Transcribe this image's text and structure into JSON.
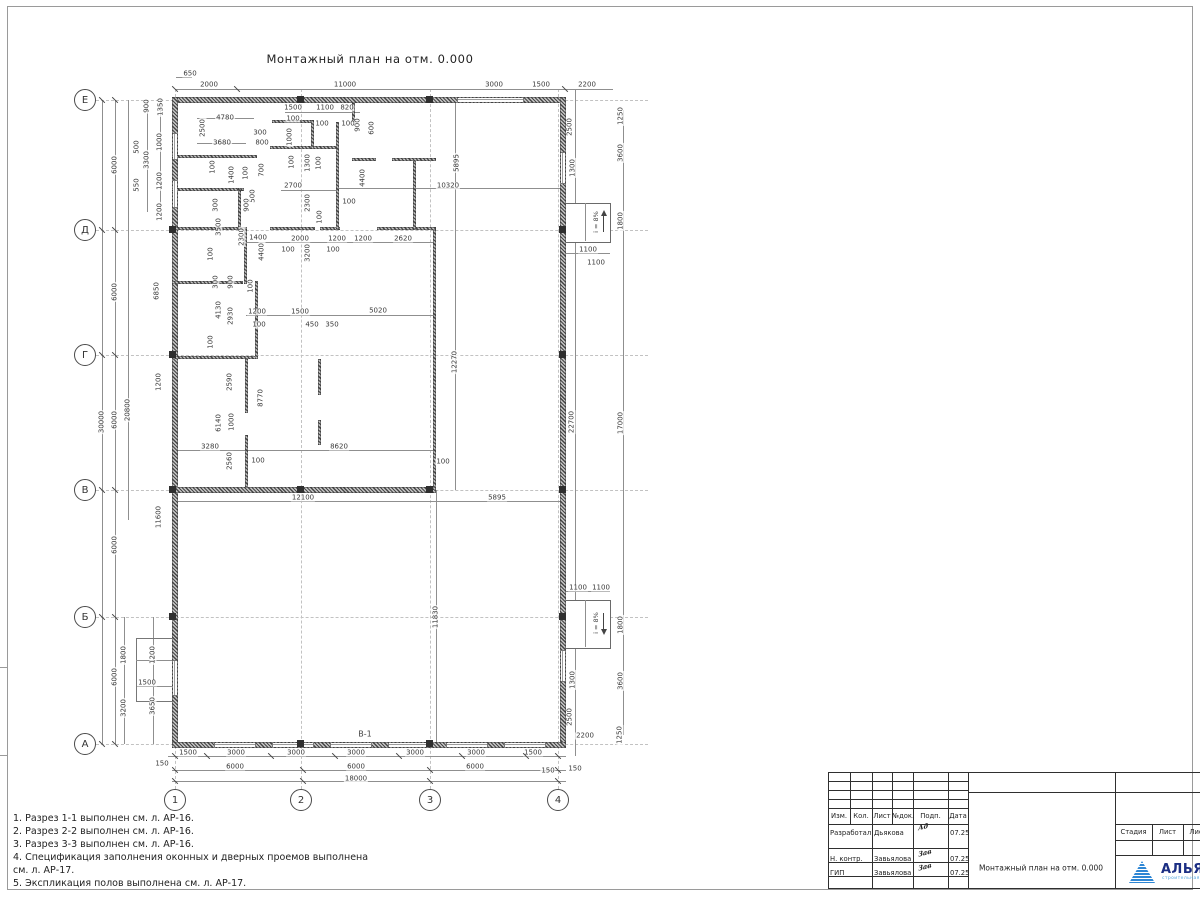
{
  "sheet": {
    "title": "Монтажный план на отм. 0.000",
    "plan_label": "В-1",
    "ramp_label": "i = 8%"
  },
  "colors": {
    "logo_blue": "#2e86d4",
    "logo_navy": "#1b2e83",
    "logo_sub": "#53a6e0"
  },
  "axes": {
    "rows": [
      {
        "label": "Е",
        "y": 100
      },
      {
        "label": "Д",
        "y": 230
      },
      {
        "label": "Г",
        "y": 355
      },
      {
        "label": "В",
        "y": 490
      },
      {
        "label": "Б",
        "y": 617
      },
      {
        "label": "А",
        "y": 744
      }
    ],
    "cols": [
      {
        "label": "1",
        "x": 175
      },
      {
        "label": "2",
        "x": 301
      },
      {
        "label": "3",
        "x": 430
      },
      {
        "label": "4",
        "x": 558
      }
    ]
  },
  "notes": [
    "1. Разрез 1-1 выполнен см. л. АР-16.",
    "2. Разрез 2-2 выполнен см. л. АР-16.",
    "3. Разрез 3-3 выполнен см. л. АР-16.",
    "4. Спецификация заполнения оконных и дверных проемов выполнена",
    "см. л. АР-17.",
    "5. Экспликация полов выполнена см. л. АР-17."
  ],
  "dims": [
    {
      "t": "650",
      "x": 190,
      "y": 74
    },
    {
      "t": "2000",
      "x": 209,
      "y": 85
    },
    {
      "t": "11000",
      "x": 345,
      "y": 85
    },
    {
      "t": "3000",
      "x": 494,
      "y": 85
    },
    {
      "t": "1500",
      "x": 541,
      "y": 85
    },
    {
      "t": "2200",
      "x": 587,
      "y": 85
    },
    {
      "t": "1250",
      "x": 621,
      "y": 116,
      "v": 1
    },
    {
      "t": "2500",
      "x": 570,
      "y": 127,
      "v": 1
    },
    {
      "t": "3600",
      "x": 621,
      "y": 153,
      "v": 1
    },
    {
      "t": "1300",
      "x": 573,
      "y": 168,
      "v": 1
    },
    {
      "t": "1800",
      "x": 621,
      "y": 221,
      "v": 1
    },
    {
      "t": "1100",
      "x": 588,
      "y": 250
    },
    {
      "t": "1100",
      "x": 596,
      "y": 263
    },
    {
      "t": "5895",
      "x": 457,
      "y": 163,
      "v": 1
    },
    {
      "t": "10320",
      "x": 448,
      "y": 186
    },
    {
      "t": "4400",
      "x": 363,
      "y": 178,
      "v": 1
    },
    {
      "t": "12270",
      "x": 455,
      "y": 362,
      "v": 1
    },
    {
      "t": "22700",
      "x": 572,
      "y": 422,
      "v": 1
    },
    {
      "t": "17000",
      "x": 621,
      "y": 423,
      "v": 1
    },
    {
      "t": "5895",
      "x": 497,
      "y": 498
    },
    {
      "t": "11830",
      "x": 436,
      "y": 617,
      "v": 1
    },
    {
      "t": "1100",
      "x": 578,
      "y": 588
    },
    {
      "t": "1100",
      "x": 601,
      "y": 588
    },
    {
      "t": "1800",
      "x": 621,
      "y": 625,
      "v": 1
    },
    {
      "t": "3600",
      "x": 621,
      "y": 681,
      "v": 1
    },
    {
      "t": "1300",
      "x": 573,
      "y": 680,
      "v": 1
    },
    {
      "t": "2500",
      "x": 570,
      "y": 717,
      "v": 1
    },
    {
      "t": "2200",
      "x": 585,
      "y": 736
    },
    {
      "t": "1250",
      "x": 620,
      "y": 735,
      "v": 1
    },
    {
      "t": "150",
      "x": 575,
      "y": 769
    },
    {
      "t": "900",
      "x": 147,
      "y": 106,
      "v": 1
    },
    {
      "t": "1350",
      "x": 161,
      "y": 107,
      "v": 1
    },
    {
      "t": "500",
      "x": 137,
      "y": 147,
      "v": 1
    },
    {
      "t": "1000",
      "x": 160,
      "y": 142,
      "v": 1
    },
    {
      "t": "3300",
      "x": 147,
      "y": 160,
      "v": 1
    },
    {
      "t": "550",
      "x": 137,
      "y": 185,
      "v": 1
    },
    {
      "t": "1200",
      "x": 160,
      "y": 181,
      "v": 1
    },
    {
      "t": "1200",
      "x": 160,
      "y": 212,
      "v": 1
    },
    {
      "t": "6000",
      "x": 115,
      "y": 165,
      "v": 1
    },
    {
      "t": "6850",
      "x": 157,
      "y": 291,
      "v": 1
    },
    {
      "t": "6000",
      "x": 115,
      "y": 292,
      "v": 1
    },
    {
      "t": "1200",
      "x": 159,
      "y": 382,
      "v": 1
    },
    {
      "t": "30000",
      "x": 102,
      "y": 422,
      "v": 1
    },
    {
      "t": "6000",
      "x": 115,
      "y": 420,
      "v": 1
    },
    {
      "t": "20800",
      "x": 128,
      "y": 410,
      "v": 1
    },
    {
      "t": "11600",
      "x": 159,
      "y": 517,
      "v": 1
    },
    {
      "t": "6000",
      "x": 115,
      "y": 545,
      "v": 1
    },
    {
      "t": "1800",
      "x": 124,
      "y": 655,
      "v": 1
    },
    {
      "t": "1200",
      "x": 153,
      "y": 655,
      "v": 1
    },
    {
      "t": "6000",
      "x": 115,
      "y": 677,
      "v": 1
    },
    {
      "t": "1500",
      "x": 147,
      "y": 683
    },
    {
      "t": "3200",
      "x": 124,
      "y": 708,
      "v": 1
    },
    {
      "t": "3650",
      "x": 153,
      "y": 706,
      "v": 1
    },
    {
      "t": "1500",
      "x": 188,
      "y": 753
    },
    {
      "t": "3000",
      "x": 236,
      "y": 753
    },
    {
      "t": "3000",
      "x": 296,
      "y": 753
    },
    {
      "t": "3000",
      "x": 356,
      "y": 753
    },
    {
      "t": "3000",
      "x": 415,
      "y": 753
    },
    {
      "t": "3000",
      "x": 476,
      "y": 753
    },
    {
      "t": "1500",
      "x": 533,
      "y": 753
    },
    {
      "t": "150",
      "x": 162,
      "y": 764
    },
    {
      "t": "150",
      "x": 548,
      "y": 771
    },
    {
      "t": "6000",
      "x": 235,
      "y": 767
    },
    {
      "t": "6000",
      "x": 356,
      "y": 767
    },
    {
      "t": "6000",
      "x": 475,
      "y": 767
    },
    {
      "t": "18000",
      "x": 356,
      "y": 779
    },
    {
      "t": "4780",
      "x": 225,
      "y": 118
    },
    {
      "t": "2500",
      "x": 203,
      "y": 128,
      "v": 1
    },
    {
      "t": "3680",
      "x": 222,
      "y": 143
    },
    {
      "t": "300",
      "x": 260,
      "y": 133
    },
    {
      "t": "800",
      "x": 262,
      "y": 143
    },
    {
      "t": "100",
      "x": 213,
      "y": 167,
      "v": 1
    },
    {
      "t": "1400",
      "x": 232,
      "y": 175,
      "v": 1
    },
    {
      "t": "100",
      "x": 246,
      "y": 173,
      "v": 1
    },
    {
      "t": "700",
      "x": 262,
      "y": 170,
      "v": 1
    },
    {
      "t": "500",
      "x": 253,
      "y": 196,
      "v": 1
    },
    {
      "t": "900",
      "x": 247,
      "y": 205,
      "v": 1
    },
    {
      "t": "300",
      "x": 216,
      "y": 205,
      "v": 1
    },
    {
      "t": "3500",
      "x": 219,
      "y": 227,
      "v": 1
    },
    {
      "t": "2300",
      "x": 242,
      "y": 237,
      "v": 1
    },
    {
      "t": "1400",
      "x": 258,
      "y": 238
    },
    {
      "t": "100",
      "x": 211,
      "y": 254,
      "v": 1
    },
    {
      "t": "300",
      "x": 216,
      "y": 282,
      "v": 1
    },
    {
      "t": "900",
      "x": 231,
      "y": 282,
      "v": 1
    },
    {
      "t": "100",
      "x": 251,
      "y": 286,
      "v": 1
    },
    {
      "t": "4400",
      "x": 262,
      "y": 252,
      "v": 1
    },
    {
      "t": "4130",
      "x": 219,
      "y": 310,
      "v": 1
    },
    {
      "t": "2930",
      "x": 231,
      "y": 316,
      "v": 1
    },
    {
      "t": "1200",
      "x": 257,
      "y": 312
    },
    {
      "t": "100",
      "x": 259,
      "y": 325
    },
    {
      "t": "1500",
      "x": 300,
      "y": 312
    },
    {
      "t": "450",
      "x": 312,
      "y": 325
    },
    {
      "t": "350",
      "x": 332,
      "y": 325
    },
    {
      "t": "5020",
      "x": 378,
      "y": 311
    },
    {
      "t": "100",
      "x": 211,
      "y": 342,
      "v": 1
    },
    {
      "t": "2590",
      "x": 230,
      "y": 382,
      "v": 1
    },
    {
      "t": "8770",
      "x": 261,
      "y": 398,
      "v": 1
    },
    {
      "t": "6140",
      "x": 219,
      "y": 423,
      "v": 1
    },
    {
      "t": "1000",
      "x": 232,
      "y": 422,
      "v": 1
    },
    {
      "t": "3280",
      "x": 210,
      "y": 447
    },
    {
      "t": "8620",
      "x": 339,
      "y": 447
    },
    {
      "t": "2560",
      "x": 230,
      "y": 461,
      "v": 1
    },
    {
      "t": "100",
      "x": 258,
      "y": 461
    },
    {
      "t": "100",
      "x": 443,
      "y": 462
    },
    {
      "t": "12100",
      "x": 303,
      "y": 498
    },
    {
      "t": "1500",
      "x": 293,
      "y": 108
    },
    {
      "t": "1100",
      "x": 325,
      "y": 108
    },
    {
      "t": "820",
      "x": 347,
      "y": 108
    },
    {
      "t": "100",
      "x": 293,
      "y": 119
    },
    {
      "t": "100",
      "x": 322,
      "y": 124
    },
    {
      "t": "100",
      "x": 348,
      "y": 124
    },
    {
      "t": "900",
      "x": 358,
      "y": 125,
      "v": 1
    },
    {
      "t": "600",
      "x": 372,
      "y": 128,
      "v": 1
    },
    {
      "t": "1000",
      "x": 290,
      "y": 137,
      "v": 1
    },
    {
      "t": "100",
      "x": 292,
      "y": 162,
      "v": 1
    },
    {
      "t": "1300",
      "x": 308,
      "y": 163,
      "v": 1
    },
    {
      "t": "100",
      "x": 319,
      "y": 163,
      "v": 1
    },
    {
      "t": "2700",
      "x": 293,
      "y": 186
    },
    {
      "t": "2300",
      "x": 308,
      "y": 203,
      "v": 1
    },
    {
      "t": "100",
      "x": 349,
      "y": 202
    },
    {
      "t": "100",
      "x": 320,
      "y": 217,
      "v": 1
    },
    {
      "t": "3200",
      "x": 308,
      "y": 253,
      "v": 1
    },
    {
      "t": "2000",
      "x": 300,
      "y": 239
    },
    {
      "t": "1200",
      "x": 337,
      "y": 239
    },
    {
      "t": "1200",
      "x": 363,
      "y": 239
    },
    {
      "t": "2620",
      "x": 403,
      "y": 239
    },
    {
      "t": "100",
      "x": 288,
      "y": 250
    },
    {
      "t": "100",
      "x": 333,
      "y": 250
    }
  ],
  "titleblock": {
    "header_cols": [
      "Изм.",
      "Кол.",
      "Лист",
      "№док.",
      "Подп.",
      "Дата"
    ],
    "rows": [
      {
        "role": "Разработал",
        "name": "Дьякова",
        "sig": "Ад",
        "date": "07.25"
      },
      {
        "role": "Н. контр.",
        "name": "Завьялова",
        "sig": "Зав",
        "date": "07.25"
      },
      {
        "role": "ГИП",
        "name": "Завьялова",
        "sig": "Зав",
        "date": "07.25"
      }
    ],
    "doc_title": "Монтажный план на отм. 0.000",
    "stage_cols": [
      "Стадия",
      "Лист",
      "Лист"
    ],
    "logo": {
      "name": "АЛЬЯНС",
      "sub": "строительная компания"
    }
  }
}
